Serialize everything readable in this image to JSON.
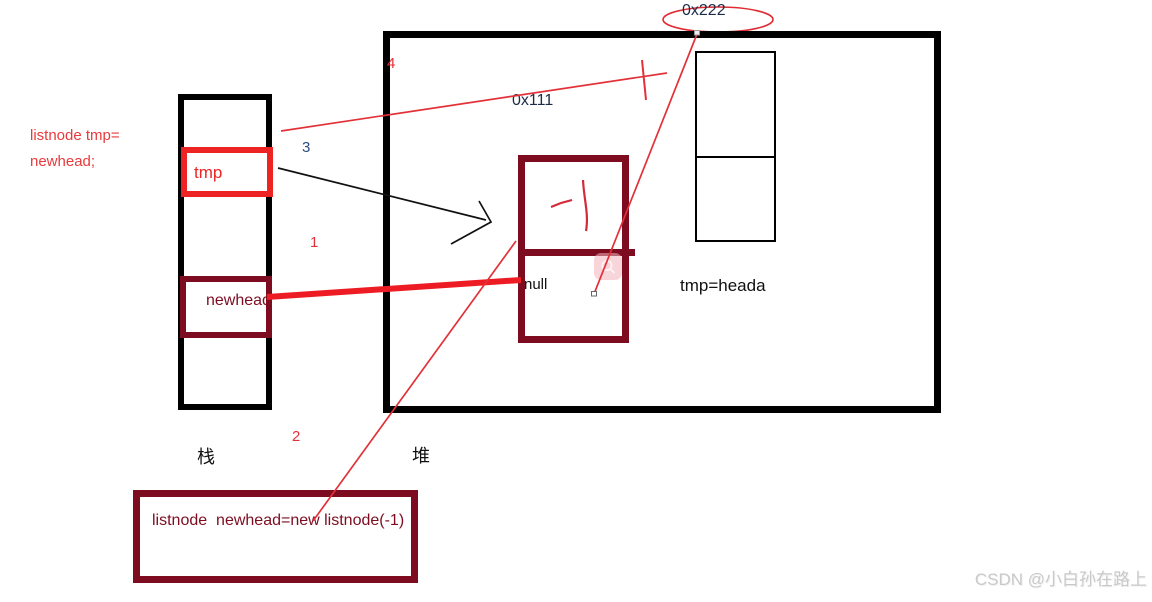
{
  "colors": {
    "bright_red": "#ee2424",
    "thin_line_red": "#e23138",
    "thick_line_red": "#ed1c24",
    "dark_maroon": "#7d0c20",
    "navy_text": "#1c2b48",
    "black": "#000000",
    "watermark_gray": "#c9c9c9"
  },
  "left_annotation": {
    "line1": "listnode tmp=",
    "line2": "newhead;"
  },
  "stack": {
    "caption": "栈",
    "cells": {
      "tmp": "tmp",
      "newhead": "newhead"
    }
  },
  "heap": {
    "caption": "堆",
    "address_label": "0x111",
    "address_bubble": "0x222",
    "node": {
      "value": "-1",
      "next": "null"
    },
    "note": "tmp=heada"
  },
  "step_numbers": {
    "n1": "1",
    "n2": "2",
    "n3": "3",
    "n4": "4"
  },
  "bottom_code_box": {
    "code": "listnode  newhead=new listnode(-1)"
  },
  "icons": {
    "magnifier": "image-preview-magnifier"
  },
  "watermark": "CSDN @小白孙在路上"
}
